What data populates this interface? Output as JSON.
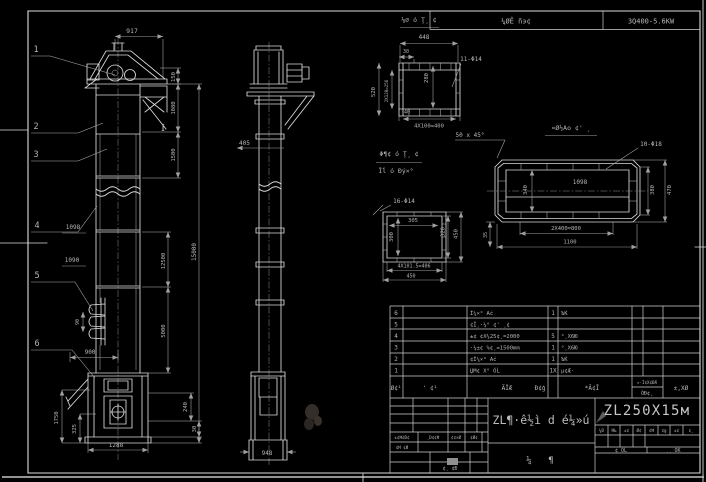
{
  "sheet": {
    "motor_table": {
      "label": "¼ØÊ ñэ¢",
      "spec": "3Q400-5.6KW"
    },
    "section_mark": "I",
    "callouts": {
      "c1": "1",
      "c2": "2",
      "c3": "3",
      "c4": "4",
      "c5": "5",
      "c6": "6"
    },
    "front": {
      "w917": "917",
      "h150": "150",
      "h1080": "1080",
      "h1500": "1500",
      "h15000": "15000",
      "h12500": "12500",
      "h5000": "5000",
      "l1098": "1098",
      "l1090": "1090",
      "bucket90": "90",
      "d900": "900",
      "l1750": "1750",
      "l325": "325",
      "b1288": "1288",
      "r240": "240",
      "r30": "30"
    },
    "side": {
      "d405": "405",
      "b948": "948"
    },
    "detail_a": {
      "title": "⅛∅ ó Ţ¸ ¢",
      "w448": "448",
      "d30": "30",
      "v520": "520",
      "v2x128": "2X128=256",
      "v280": "280",
      "holes": "11-Φ14",
      "d40": "40",
      "b4x100": "4X100=400"
    },
    "detail_b": {
      "note1": "Φ¶¢ ó Ţ¸ ¢",
      "note2": "Ĭĺ ó Ðý×°",
      "holes": "16-Φ14",
      "ih305": "305",
      "iv300": "300",
      "rv320": "320",
      "rv450": "450",
      "b406": "4X101.5=406",
      "b450": "450"
    },
    "detail_c": {
      "chamfer": "50 x 45°",
      "title": "¤Ø½Ао ¢' ¸",
      "holes": "10-Φ18",
      "i1098": "1098",
      "lv340": "340",
      "rv380": "380",
      "rv470": "470",
      "b800": "2X400=800",
      "b1100": "1100",
      "lv35": "35"
    },
    "parts_table": {
      "rows": [
        {
          "no": "6",
          "code": "",
          "name": "Ĭ¼×° Аć",
          "qty": "1",
          "mat": "ЪЌ",
          "rem": ""
        },
        {
          "no": "5",
          "code": "",
          "name": "¢Ĭ¸·¼° ¢' ¸¢",
          "qty": "",
          "mat": "",
          "rem": ""
        },
        {
          "no": "4",
          "code": "",
          "name": "±¢ ¢X¼25¢¸=2000",
          "qty": "5",
          "mat": "°¸X6Ю",
          "rem": ""
        },
        {
          "no": "3",
          "code": "",
          "name": "·¼±¢ %¢¸=1500mm",
          "qty": "1",
          "mat": "°¸X6Ю",
          "rem": ""
        },
        {
          "no": "2",
          "code": "",
          "name": "¢Ĭ¼×° Аć",
          "qty": "1",
          "mat": "ЪЌ",
          "rem": ""
        },
        {
          "no": "1",
          "code": "",
          "name": "ЏΜ¢ X° ÓĹ",
          "qty": "1X",
          "mat": "μ¢Æ·",
          "rem": ""
        }
      ],
      "headers": {
        "no": "Ø¢¹",
        "code": "' ¢¹",
        "name": "ÃЇÆ",
        "qty": "Đ¢ģ",
        "mat": "*Ā¢Ī",
        "note_top": "¤·Ĩ¢X¢ĐÆ",
        "note_bot": "ÓÐ¢¸",
        "rem": "±,XØ"
      }
    },
    "title_block": {
      "main_title": "ZL¶·ê½ì d é¼»ú",
      "model": "ZL250X15м",
      "subtitle_l": "¼",
      "subtitle_r": "¶",
      "small_cells": [
        "¼Ð",
        "ĦЬ",
        "±¢",
        "Ø¢",
        "¢Ħ",
        "¢g",
        "±¢",
        "¢¸"
      ],
      "sig_left": "¢ ÓĹ",
      "sig_right": "¸¸ ÓЌ",
      "rev_row": [
        "±¢Ħ¢Đ¢",
        "¸Đ¢¢Ħ",
        "¢¢×Ø",
        "¢Ø¢"
      ],
      "rev_row2": "¢Ħ ¢Ø",
      "rev_bottom": "¢¸ ¢Ð"
    }
  }
}
